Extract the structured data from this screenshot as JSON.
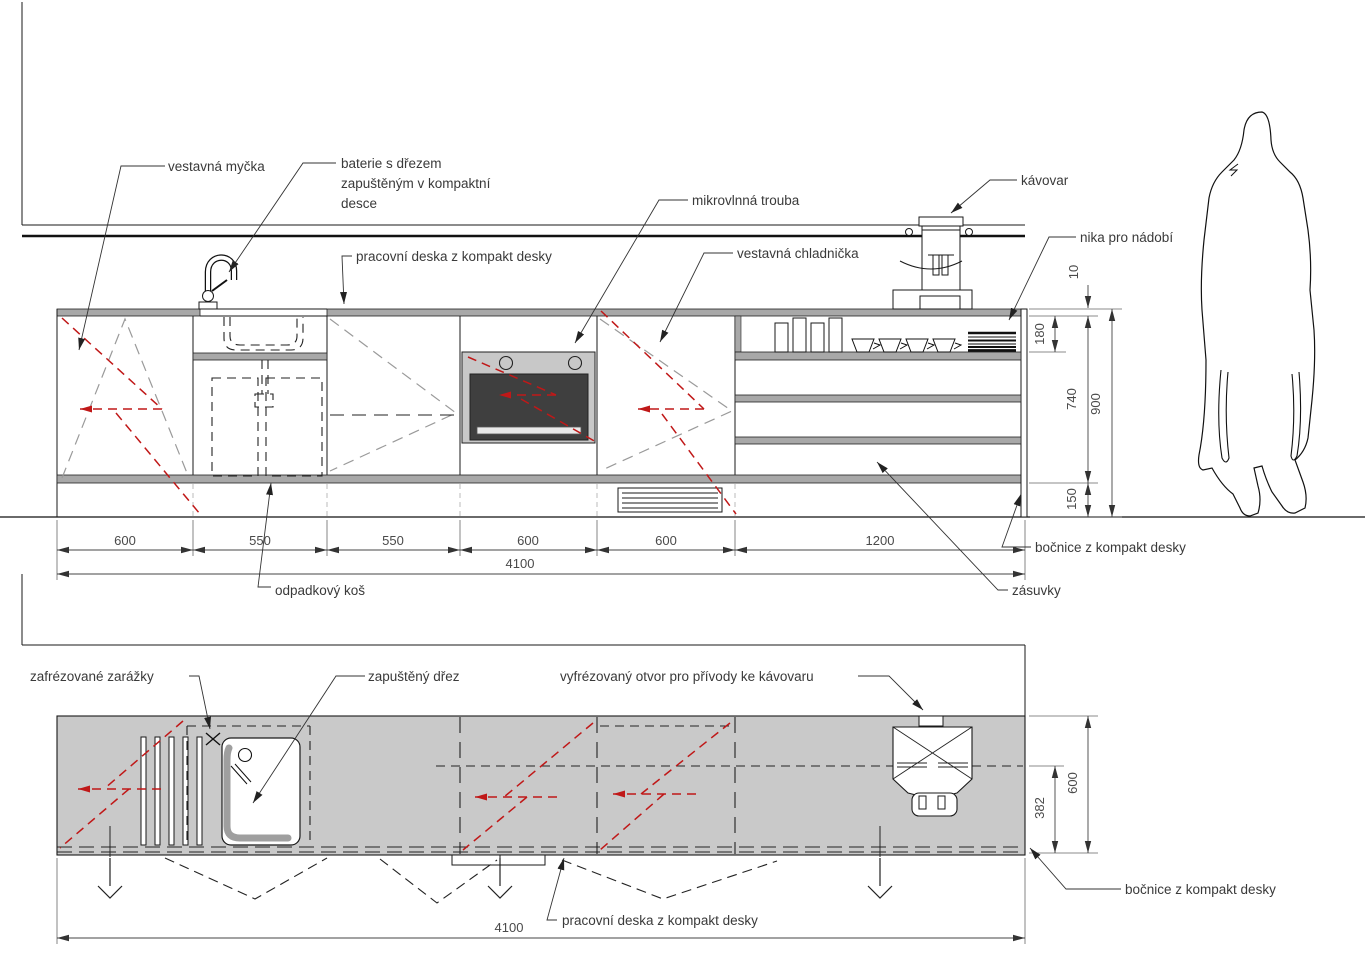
{
  "drawing_type": "kitchen cabinetry technical drawing (elevation and plan)",
  "colors": {
    "line": "#1a1a1a",
    "label_text": "#3a3a3a",
    "dim_text": "#4a4a4a",
    "red_symbol": "#c01818",
    "gray_symbol": "#9a9a9a",
    "worktop_band": "#a8a8a8",
    "plan_slab": "#c9c9c9",
    "microwave_frame": "#c8c8c8",
    "microwave_door": "#3f3f3f"
  },
  "elevation": {
    "labels": {
      "dishwasher": "vestavná myčka",
      "faucet_line1": "baterie s dřezem",
      "faucet_line2": "zapuštěným v kompaktní",
      "faucet_line3": "desce",
      "worktop": "pracovní deska z kompakt desky",
      "microwave": "mikrovlnná trouba",
      "fridge": "vestavná chladnička",
      "coffee_machine": "kávovar",
      "niche": "nika pro nádobí",
      "trash_bin": "odpadkový koš",
      "drawers": "zásuvky",
      "side_panel": "bočnice z kompakt desky"
    },
    "dims": {
      "widths": [
        "600",
        "550",
        "550",
        "600",
        "600",
        "1200"
      ],
      "total": "4100",
      "worktop_thickness": "10",
      "niche_height": "180",
      "carcass_height": "740",
      "worktop_height": "900",
      "plinth_height": "150"
    }
  },
  "plan": {
    "labels": {
      "milled_stops": "zafrézované zarážky",
      "recessed_sink": "zapuštěný dřez",
      "coffee_cutout": "vyfrézovaný otvor pro přívody ke kávovaru",
      "worktop": "pracovní deska z kompakt desky",
      "side_panel": "bočnice z kompakt desky"
    },
    "dims": {
      "total": "4100",
      "depth": "600",
      "front_depth": "382"
    }
  }
}
